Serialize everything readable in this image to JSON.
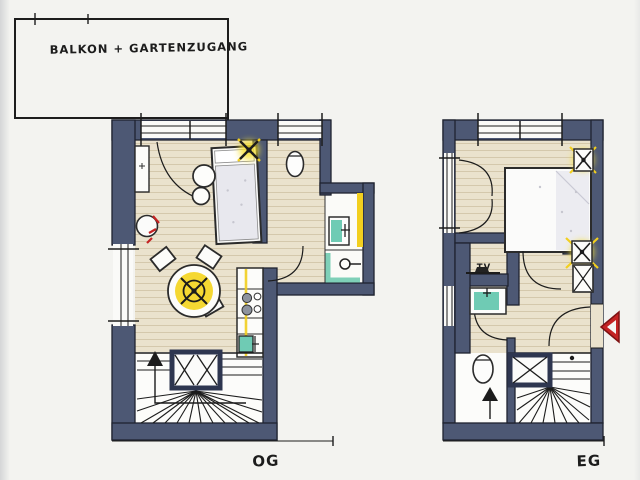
{
  "annotation": {
    "balcony_label": "BALKON + GARTENZUGANG"
  },
  "plans": {
    "og": {
      "label": "OG"
    },
    "eg": {
      "label": "EG",
      "tv_label": "TV"
    }
  },
  "icons": {
    "ceiling_lamp": "x-cross-with-dot",
    "stairs_direction": "up-arrow",
    "entrance_marker": "left-pointing-triangle",
    "shower_head": "circle-with-arm",
    "elevator_shaft": "crossed-box"
  },
  "colors": {
    "paper": "#f3f3f0",
    "wall": "#4d5874",
    "ink": "#1f2330",
    "wood_floor": "#eae2cd",
    "wood_line": "#cdbfa2",
    "accent_yellow": "#f2cf1f",
    "lamp_glow": "#f7e133",
    "fixture_teal": "#6fcbb4",
    "accent_red": "#c42323",
    "bed_linen": "#e8e8ee"
  }
}
